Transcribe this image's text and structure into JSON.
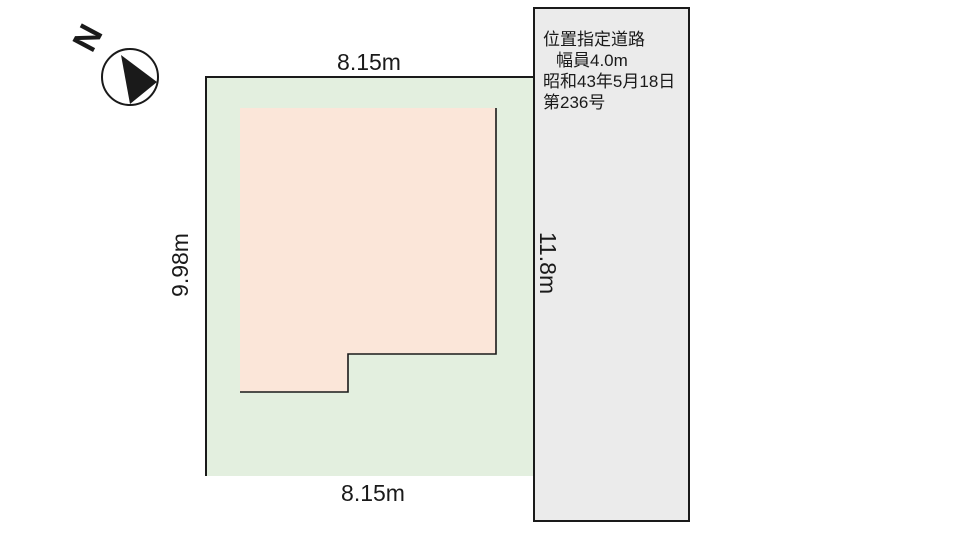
{
  "compass": {
    "north_label": "N"
  },
  "plot": {
    "top_width_label": "8.15m",
    "bottom_width_label": "8.15m",
    "left_depth_label": "9.98m"
  },
  "road": {
    "lines": {
      "0": "位置指定道路",
      "1": "幅員4.0m",
      "2": "昭和43年5月18日",
      "3": "第236号"
    },
    "length_label": "11.8m"
  },
  "colors": {
    "plot_green": "#e3efdf",
    "building_pink": "#fbe6d9",
    "road_gray": "#ebebeb",
    "line_black": "#1a1a1a"
  }
}
